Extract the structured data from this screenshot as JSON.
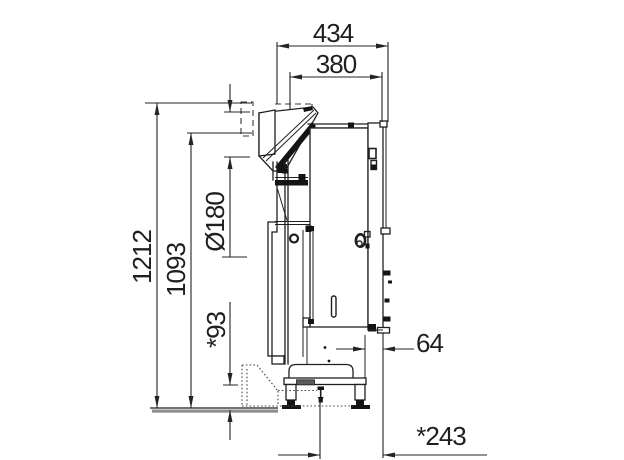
{
  "drawing": {
    "type": "technical-side-view",
    "dimensions": {
      "top_width": "434",
      "inner_width": "380",
      "total_height": "1212",
      "body_height": "1093",
      "diameter": "Ø180",
      "base_height": "*93",
      "rear_offset": "64",
      "base_depth": "*243"
    }
  }
}
